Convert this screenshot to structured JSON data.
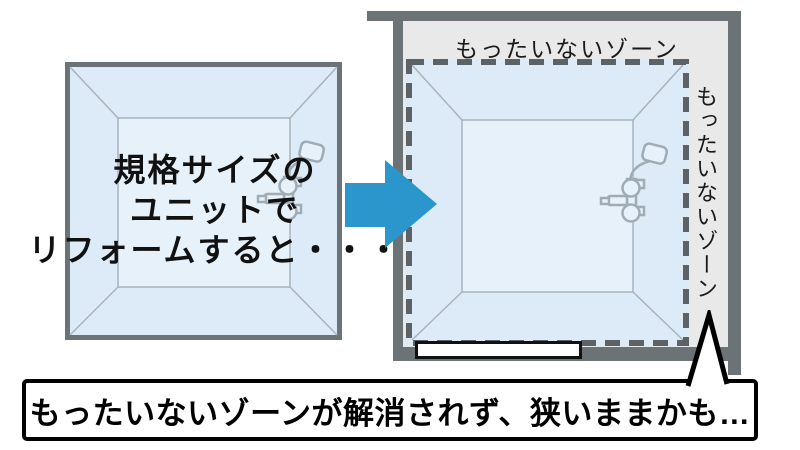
{
  "left_unit": {
    "caption_lines": [
      "規格サイズの",
      "ユニットで",
      "リフォームすると・・・"
    ]
  },
  "right_room": {
    "top_zone_label": "もったいないゾーン",
    "side_zone_label": "もったいないゾーン"
  },
  "callout": {
    "text": "もったいないゾーンが解消されず、狭いままかも…"
  },
  "icons": {
    "arrow": "right-arrow",
    "fixture": "shower-fixture"
  },
  "colors": {
    "arrow_blue": "#2b96cc",
    "wall_gray": "#6c7376",
    "zone_gray": "#e9e9e9",
    "unit_blue": "#dcebf7",
    "unit_blue_inner": "#e7f1fa",
    "dash_gray": "#5c6266",
    "line_gray": "#a9b3bc",
    "fixture_line": "#9fabb5",
    "text_black": "#111111"
  }
}
